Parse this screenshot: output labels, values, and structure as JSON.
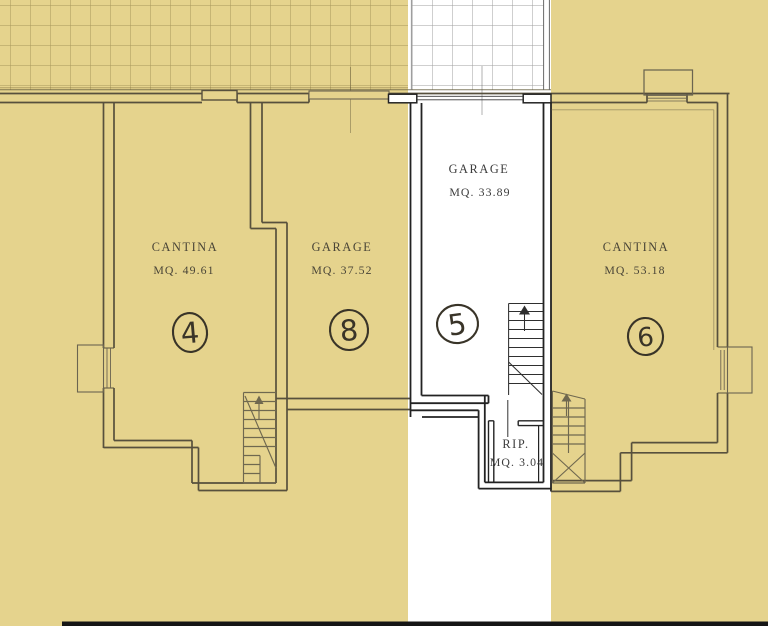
{
  "plan": {
    "rooms": {
      "cantina4": {
        "label": "CANTINA",
        "area": "MQ. 49.61",
        "unit": "4"
      },
      "garage8": {
        "label": "GARAGE",
        "area": "MQ. 37.52",
        "unit": "8"
      },
      "garage5": {
        "label": "GARAGE",
        "area": "MQ. 33.89",
        "unit": "5"
      },
      "cantina6": {
        "label": "CANTINA",
        "area": "MQ. 53.18",
        "unit": "6"
      },
      "rip": {
        "label": "RIP.",
        "area": "MQ. 3.04"
      }
    },
    "palette": {
      "highlight_yellow": "#e5d38d",
      "wall_brown": "#57503d",
      "wall_black": "#232323",
      "stair_line": "#6f684f",
      "text_ink": "#4a4537"
    }
  }
}
